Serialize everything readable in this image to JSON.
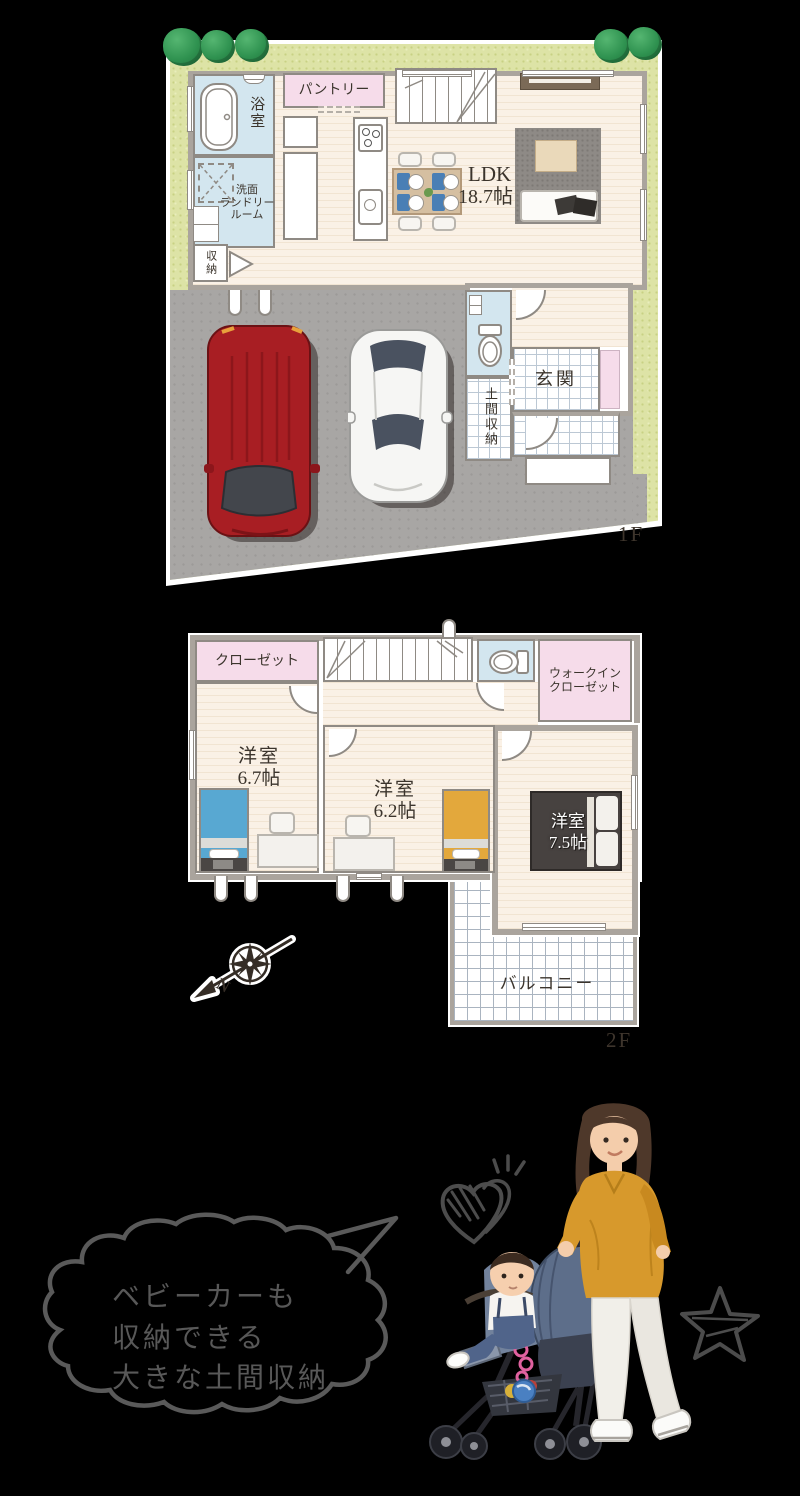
{
  "floor1": {
    "tag": "1F",
    "bath": "浴室",
    "pantry": "パントリー",
    "laundry_line1": "洗面",
    "laundry_line2": "ランドリー",
    "laundry_line3": "ルーム",
    "storage": "収納",
    "ldk_name": "LDK",
    "ldk_size": "18.7帖",
    "genkan": "玄関",
    "doma": "土間収納"
  },
  "floor2": {
    "tag": "2F",
    "closet_left": "クローゼット",
    "walkin_line1": "ウォークイン",
    "walkin_line2": "クローゼット",
    "closet_mid": "クローゼット",
    "room_a_name": "洋室",
    "room_a_size": "6.7帖",
    "room_b_name": "洋室",
    "room_b_size": "6.2帖",
    "room_c_name": "洋室",
    "room_c_size": "7.5帖",
    "balcony": "バルコニー"
  },
  "compass": {
    "north": "N"
  },
  "callout": {
    "line1": "ベビーカーも",
    "line2": "収納できる",
    "line3": "大きな土間収納"
  },
  "colors": {
    "room_pink": "#f6dcea",
    "room_blue": "#d3e6ef",
    "floor_cream": "#faf1e6",
    "wall_gray": "#aaa49d",
    "grass_green": "#dde3a6",
    "driveway_gray": "#a8a6a4",
    "car_red": "#a81e23",
    "bed_blue": "#58a8d2",
    "bed_yellow": "#e3a83c",
    "sweater_yellow": "#d7992c"
  }
}
